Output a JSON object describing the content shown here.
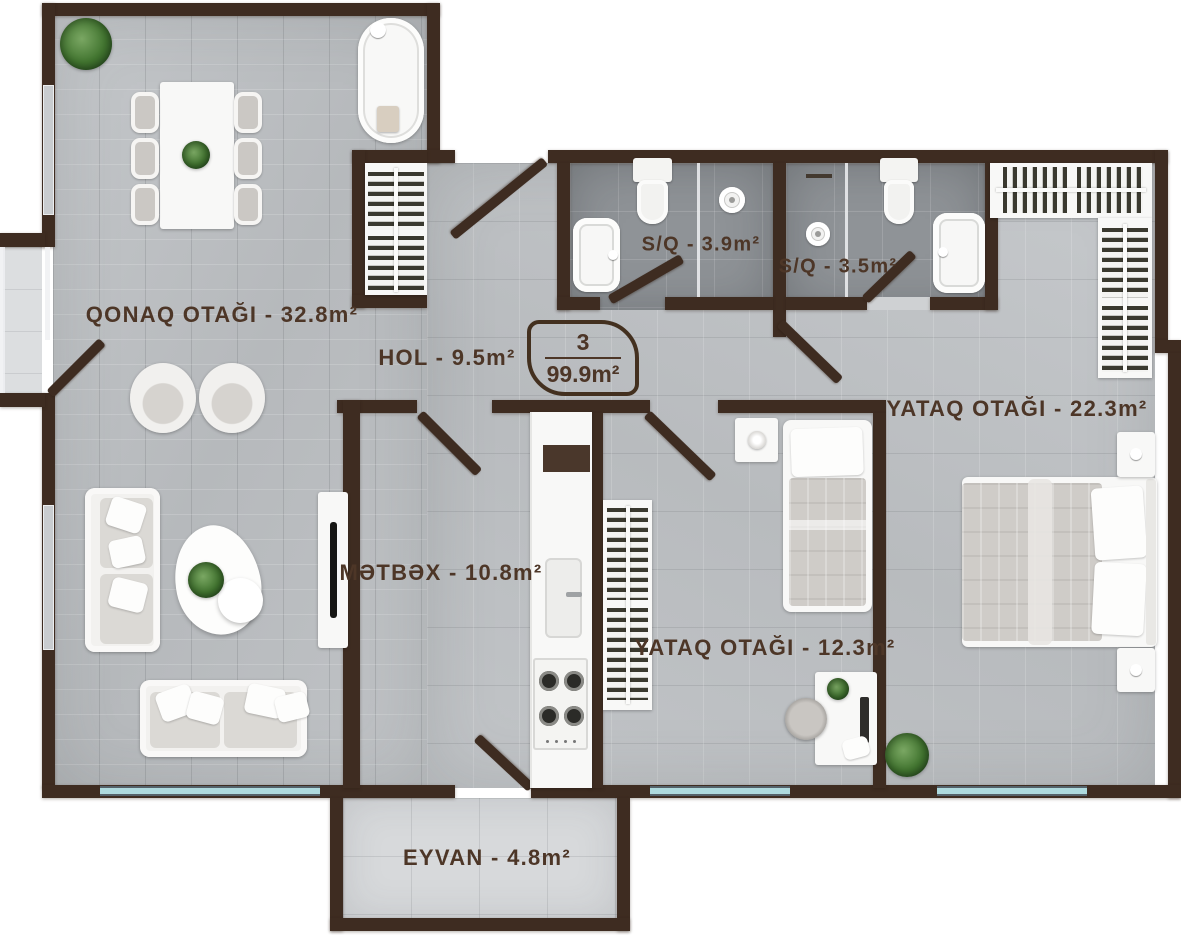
{
  "unit_badge": {
    "number": "3",
    "total_area": "99.9m²"
  },
  "rooms": [
    {
      "key": "living-room",
      "label": "QONAQ OTAĞI - 32.8m²"
    },
    {
      "key": "hall",
      "label": "HOL - 9.5m²"
    },
    {
      "key": "bathroom-1",
      "label": "S/Q - 3.9m²"
    },
    {
      "key": "bathroom-2",
      "label": "S/Q - 3.5m²"
    },
    {
      "key": "bedroom-large",
      "label": "YATAQ OTAĞI - 22.3m²"
    },
    {
      "key": "kitchen",
      "label": "MƏTBƏX - 10.8m²"
    },
    {
      "key": "bedroom-small",
      "label": "YATAQ OTAĞI - 12.3m²"
    },
    {
      "key": "balcony",
      "label": "EYVAN - 4.8m²"
    }
  ],
  "colors": {
    "wall": "#3e2c21",
    "label_text": "#4d3627",
    "wood_floor": "#bdc0c3",
    "bath_floor": "#8f9397",
    "balcony_floor": "#d7d9db",
    "window_glass": "#aedade",
    "furniture_white": "#f8f8f7",
    "plant_green": "#41742f"
  }
}
